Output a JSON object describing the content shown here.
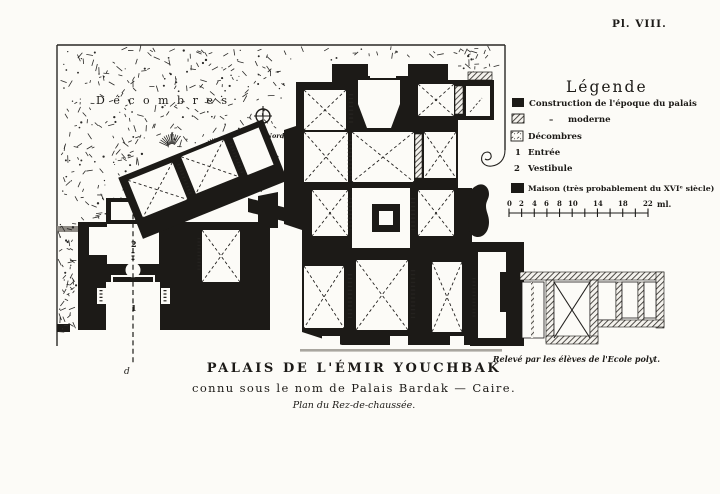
{
  "plate": {
    "label": "Pl. VIII."
  },
  "plan": {
    "rubble_label": "Décombres",
    "compass_label": "Nord",
    "entrance_marker": "1",
    "vestibule_marker": "2",
    "axis_marker": "d",
    "icons": {
      "compass": "compass-rose-icon",
      "scroll": "scroll-ornament-icon",
      "mass_blob": "maison-mass-icon"
    }
  },
  "legend": {
    "title": "Légende",
    "ditto_mark": "–",
    "items": [
      {
        "icon": "black-square-icon",
        "symbol": "",
        "label": "Construction de l'époque du palais"
      },
      {
        "icon": "hatched-square-icon",
        "symbol": "",
        "label": "moderne"
      },
      {
        "icon": "rubble-square-icon",
        "symbol": "",
        "label": "Décombres"
      },
      {
        "icon": "numeral-marker",
        "symbol": "1",
        "label": "Entrée"
      },
      {
        "icon": "numeral-marker",
        "symbol": "2",
        "label": "Vestibule"
      },
      {
        "icon": "black-square-icon",
        "symbol": "",
        "label": "Maison (très probablement du XVIᵉ siècle)"
      }
    ],
    "scale_bar": {
      "tick_labels": [
        "0",
        "2",
        "4",
        "6",
        "8",
        "10",
        "14",
        "18",
        "22"
      ],
      "unit_label": "ml."
    }
  },
  "caption": {
    "title": "PALAIS DE L'ÉMIR YOUCHBAK",
    "subtitle": "connu sous le nom de Palais Bardak  —  Caire.",
    "plan_note": "Plan du Rez-de-chaussée.",
    "credit": "Relevé par les élèves de l'Ecole polyt."
  },
  "colors": {
    "ink": "#1c1a17",
    "paper": "#fcfbf7",
    "hatch": "#3a3733"
  }
}
